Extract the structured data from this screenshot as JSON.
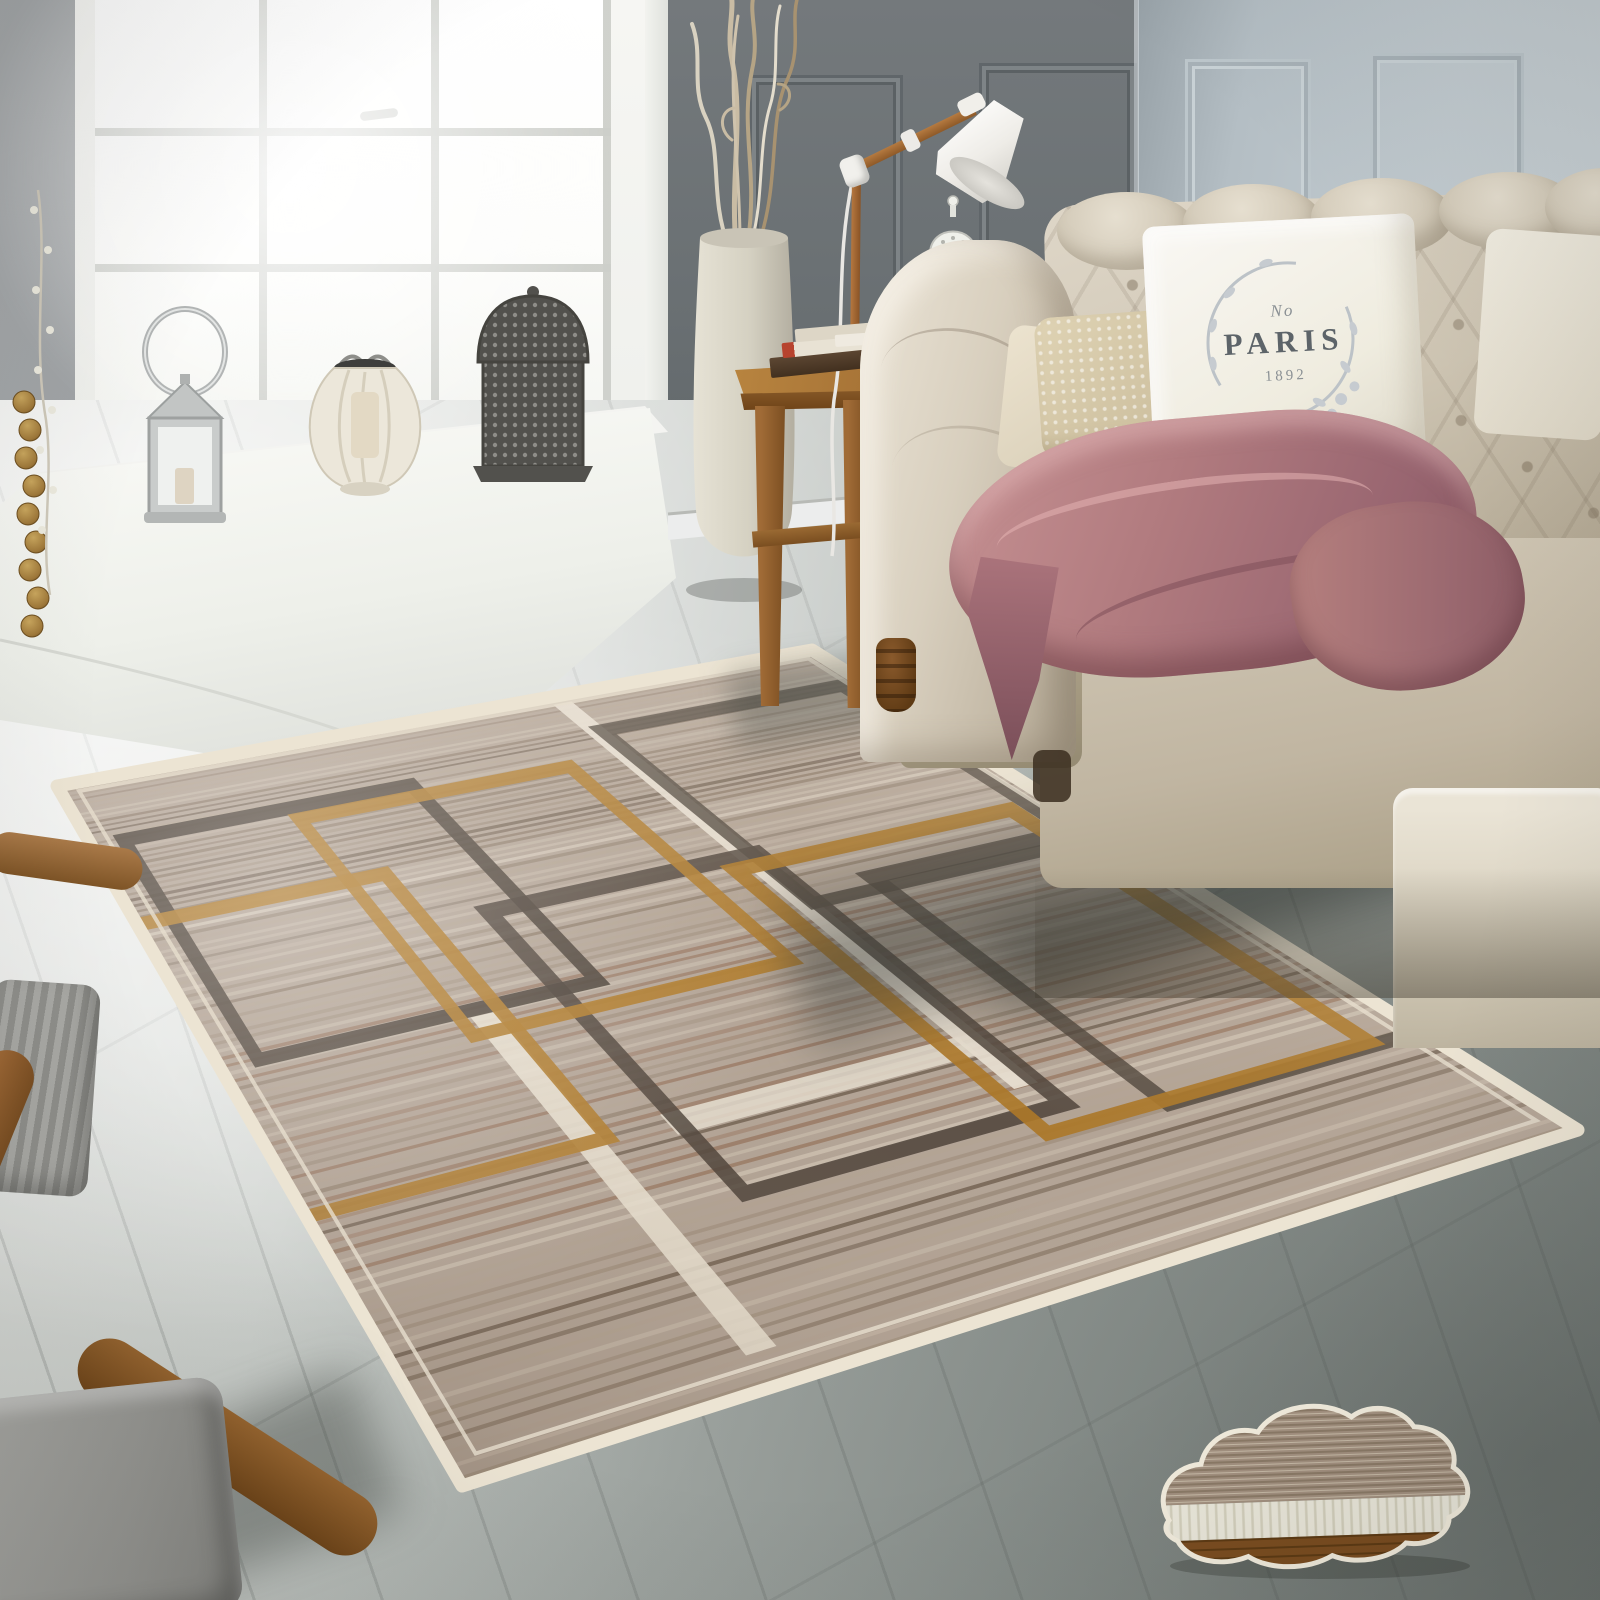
{
  "meta": {
    "description": "Product photograph of a living room: taupe geometric rug with overlapping square outlines on a grey wood floor, cream tufted chesterfield sofa with PARIS pillow and mauve throw, oak side table with books and wooden task lamp, tall cream floor vase with curly branches, bright bay window with three candle lanterns, wooden armchair corner, and a cloud-shaped rug material swatch."
  },
  "pillow": {
    "line1": "No",
    "line2": "PARIS",
    "line3": "1892"
  },
  "palette": {
    "wall_left": "#999da0",
    "wall_dark": "#6a7073",
    "wall_right": "#c2cbd0",
    "window_glass": "#fdfdfb",
    "floor_light": "#e9eae6",
    "floor_dark": "#868d89",
    "sofa": "#cdc4b2",
    "throw": "#b17b7f",
    "table_wood": "#a06d33",
    "rug_gold": "#b07c2c",
    "rug_dark": "#4d4339",
    "rug_cream": "#e9e1d2"
  },
  "rug": {
    "quad": {
      "A": [
        57,
        786
      ],
      "B": [
        812,
        650
      ],
      "C": [
        1578,
        1130
      ],
      "D": [
        462,
        1486
      ]
    },
    "base": "#b3a496",
    "stripes": {
      "count": 92,
      "tones": [
        "#c8bbab",
        "#b4a493",
        "#a08f7d",
        "#8c7a68",
        "#d4c8b8"
      ],
      "accent_red": "#96735c",
      "accent_dark": "#6e5d4d"
    },
    "border": {
      "outer": "#ece4d3",
      "inner": "#e7dfce"
    },
    "fills": [
      {
        "u0": 0.615,
        "v0": 0.02,
        "u1": 0.64,
        "v1": 0.8,
        "color": "#e9e1d2",
        "opacity": 0.92
      },
      {
        "u0": 0.235,
        "v0": 0.55,
        "u1": 0.26,
        "v1": 0.97,
        "color": "#e9e1d2",
        "opacity": 0.88
      },
      {
        "u0": 0.32,
        "v0": 0.725,
        "u1": 0.62,
        "v1": 0.752,
        "color": "#e6ded0",
        "opacity": 0.82
      }
    ],
    "outlines": [
      {
        "u0": 0.035,
        "v0": 0.14,
        "u1": 0.37,
        "v1": 0.54,
        "color": "#4d4339",
        "w": 14,
        "opacity": 0.9
      },
      {
        "u0": 0.33,
        "v0": 0.4,
        "u1": 0.64,
        "v1": 0.83,
        "color": "#4d4339",
        "w": 14,
        "opacity": 0.85
      },
      {
        "u0": 0.635,
        "v0": 0.1,
        "u1": 0.97,
        "v1": 0.5,
        "color": "#544a40",
        "w": 13,
        "opacity": 0.85
      },
      {
        "u0": 0.72,
        "v0": 0.48,
        "u1": 1.06,
        "v1": 0.86,
        "color": "#4d4339",
        "w": 13,
        "opacity": 0.8
      },
      {
        "u0": -0.04,
        "v0": 0.3,
        "u1": 0.265,
        "v1": 0.735,
        "color": "#b07c2c",
        "w": 13,
        "opacity": 0.92
      },
      {
        "u0": 0.225,
        "v0": 0.165,
        "u1": 0.555,
        "v1": 0.575,
        "color": "#b07c2c",
        "w": 13,
        "opacity": 0.92
      },
      {
        "u0": 0.6,
        "v0": 0.42,
        "u1": 0.945,
        "v1": 0.855,
        "color": "#ab7728",
        "w": 13,
        "opacity": 0.92
      }
    ]
  },
  "cloud": {
    "layers": {
      "top": "#a39180",
      "top_line": "#8b7a67",
      "middle": "#ebe8db",
      "middle_rib": "#d4d0bd",
      "bottom": "#7b4d20",
      "bottom_line": "#5d3a13"
    },
    "outline": "#f3edde"
  }
}
